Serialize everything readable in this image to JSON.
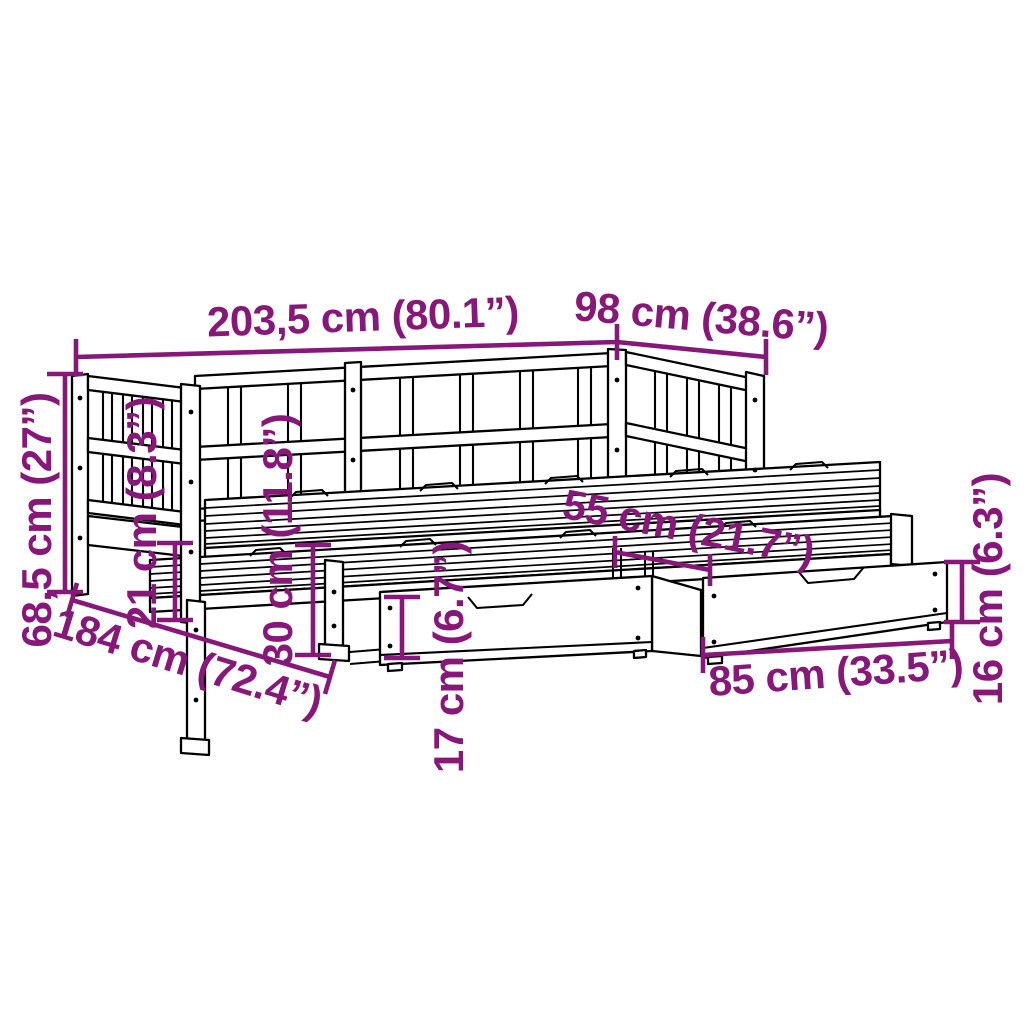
{
  "diagram": {
    "type": "product-dimension-diagram",
    "subject": "daybed-with-trundle-and-drawers",
    "background_color": "#ffffff",
    "drawing_color": "#000000",
    "accent_color": "#871778"
  },
  "labels": {
    "total_length": "203,5 cm (80.1”)",
    "total_width": "98 cm (38.6”)",
    "total_height": "68,5 cm (27”)",
    "under_bed_clearance": "21 cm (8.3”)",
    "trundle_height": "30 cm (11.8”)",
    "drawer_front_height": "17 cm (6.7”)",
    "pullout_length": "184 cm (72.4”)",
    "drawer_spacing": "55 cm (21.7”)",
    "drawer_length": "85 cm (33.5”)",
    "drawer_height": "16 cm (6.3”)"
  }
}
